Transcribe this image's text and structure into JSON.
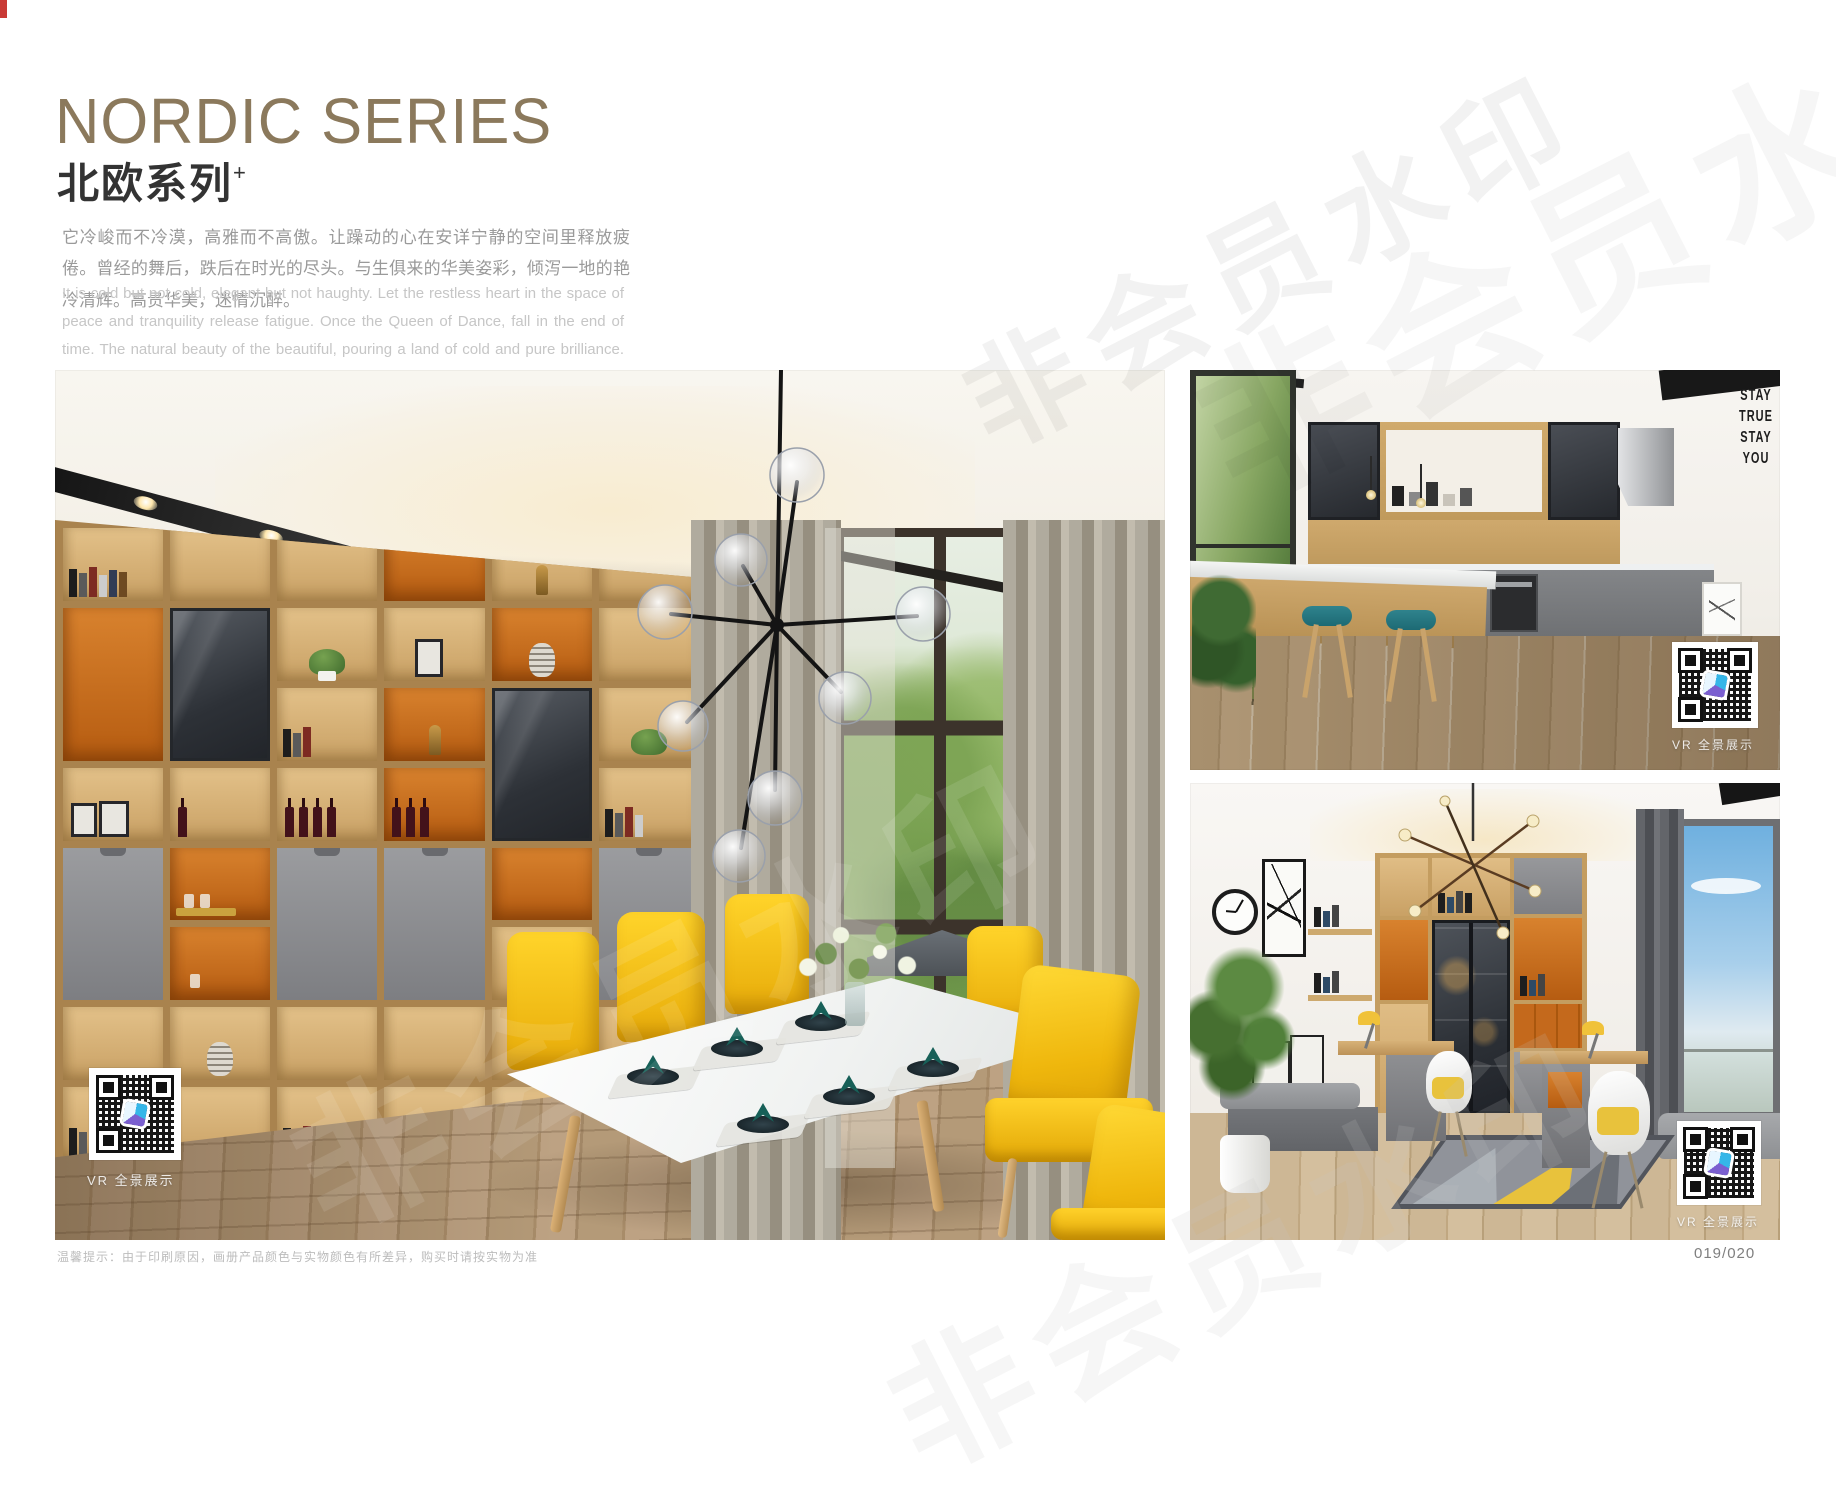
{
  "watermark": {
    "text": "非会员水印"
  },
  "header": {
    "title": "NORDIC SERIES",
    "subtitle": "北欧系列",
    "subtitle_mark": "+",
    "paragraph_zh": "它冷峻而不冷漠，高雅而不高傲。让躁动的心在安详宁静的空间里释放疲倦。曾经的舞后，跌后在时光的尽头。与生俱来的华美姿彩，倾泻一地的艳冷清辉。高贵华美，迷情沉醉。",
    "paragraph_en": "It is cold but not cold, elegant but not haughty. Let the restless heart in the space of peace and tranquility release fatigue. Once the Queen of Dance, fall in the end of time. The natural beauty of the beautiful, pouring a land of cold and pure brilliance. Noble, beautiful, enchanted."
  },
  "photos": {
    "dining": {
      "vr_label": "VR 全景展示"
    },
    "kitchen": {
      "vr_label": "VR 全景展示",
      "wall_lines": [
        "STAY",
        "TRUE",
        "STAY",
        "YOU"
      ]
    },
    "study": {
      "vr_label": "VR 全景展示"
    }
  },
  "footer": {
    "note": "温馨提示：由于印刷原因，画册产品颜色与实物颜色有所差异，购买时请按实物为准",
    "page_number": "019/020"
  },
  "colors": {
    "accent_bronze": "#8b795c",
    "wood": "#c9a166",
    "orange_niche": "#c8671e",
    "cabinet_gray": "#8c8d90",
    "chair_yellow": "#f4c70c",
    "stool_teal": "#27767f",
    "curtain_gray": "#a19c8f"
  }
}
